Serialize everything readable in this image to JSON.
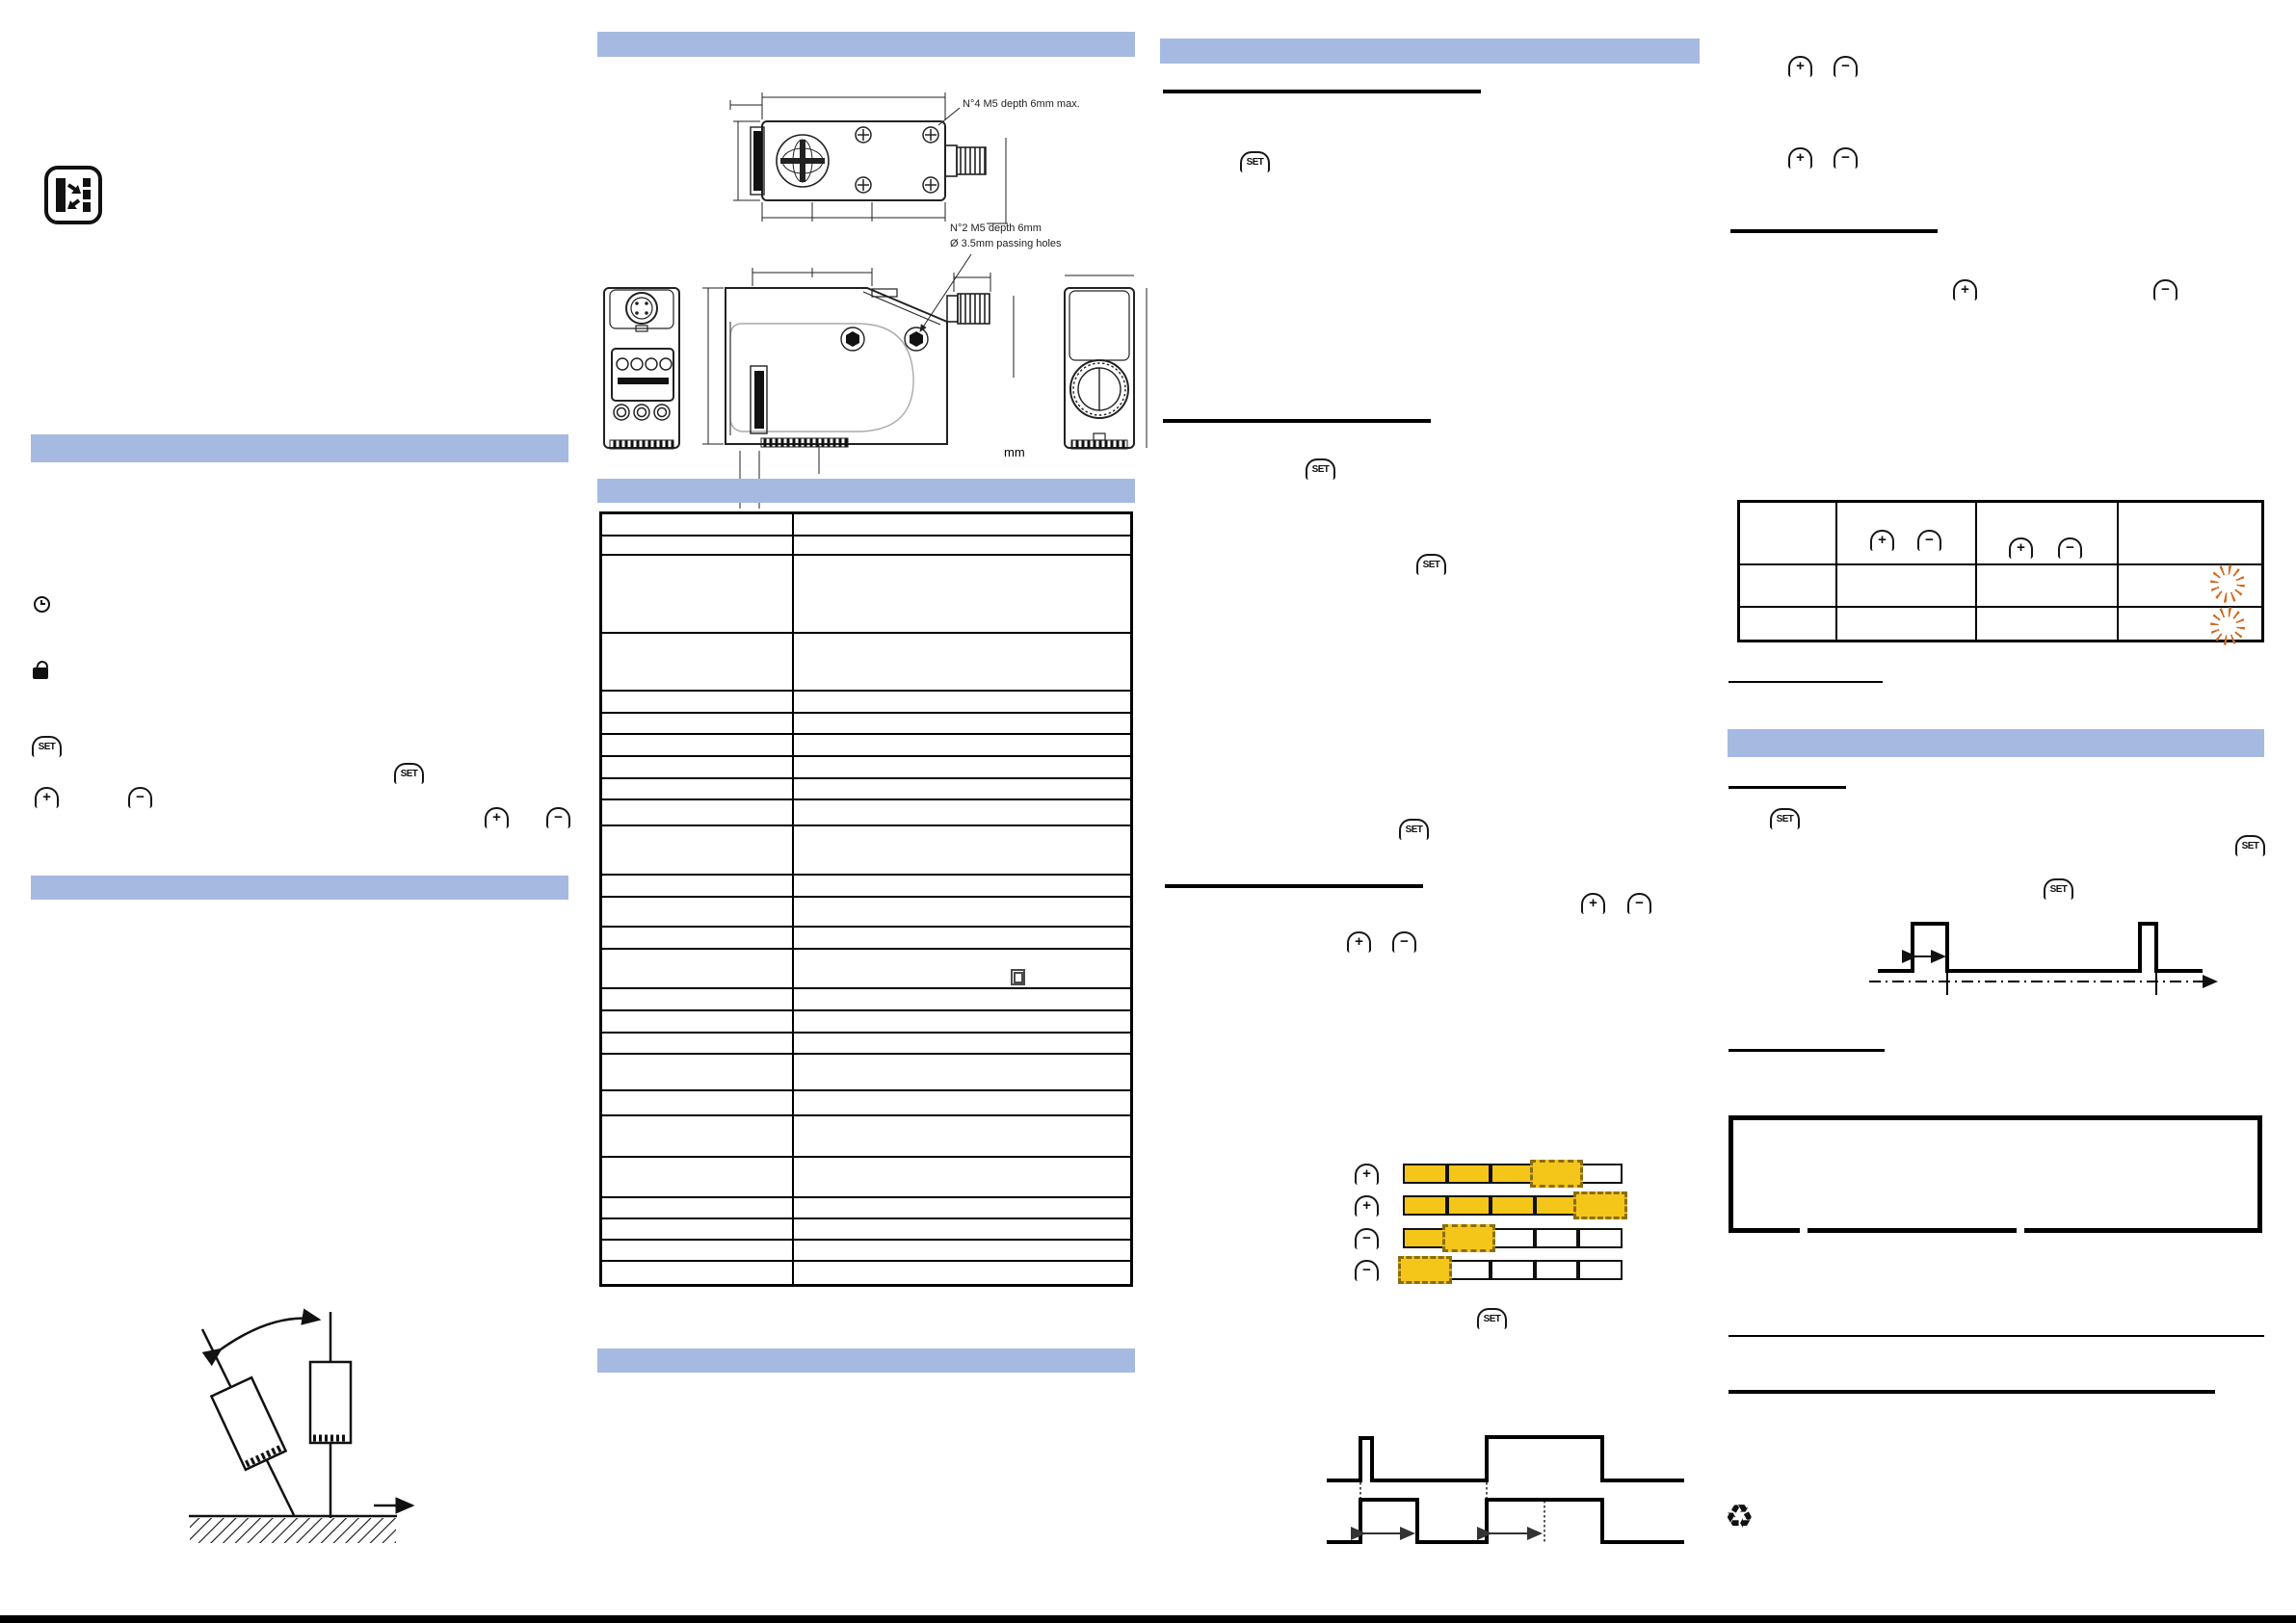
{
  "doc": {
    "colors": {
      "section_bar": "#a5b9e1",
      "led_on_yellow": "#f5c61a",
      "led_blink_dash": "#8a6d12",
      "blink_star_orange": "#d2691e",
      "line_black": "#000000"
    },
    "keys": {
      "set": "SET",
      "plus": "+",
      "minus": "−"
    },
    "glyphs": {
      "recycle": "♻"
    },
    "drawing_labels": {
      "top_note": "N°4 M5 depth 6mm max.",
      "side_note_1": "N°2 M5 depth 6mm",
      "side_note_2": "Ø 3.5mm passing holes",
      "units": "mm"
    },
    "icons": {
      "logo": "retroreflective-beam-icon",
      "clock": "response-time-icon",
      "lock": "keylock-icon",
      "class2": "double-insulation-icon",
      "blink": "blinking-led-icon",
      "recycle": "recycle-icon"
    },
    "led_figure": {
      "rows": [
        {
          "button": "plus",
          "segments": [
            "on",
            "on",
            "on",
            "blink",
            "off"
          ]
        },
        {
          "button": "plus",
          "segments": [
            "on",
            "on",
            "on",
            "on",
            "blink"
          ]
        },
        {
          "button": "minus",
          "segments": [
            "on",
            "blink",
            "off",
            "off",
            "off"
          ]
        },
        {
          "button": "minus",
          "segments": [
            "blink",
            "off",
            "off",
            "off",
            "off"
          ]
        }
      ]
    },
    "feedback_table": {
      "rows": 3,
      "cols": 4,
      "header_col2_keys": [
        "plus",
        "minus"
      ],
      "header_col3_keys": [
        "plus",
        "minus"
      ],
      "blink_cells": [
        [
          2,
          4
        ],
        [
          3,
          4
        ]
      ]
    },
    "spec_table": {
      "rows": 26,
      "columns": 2,
      "content": "empty grid"
    }
  }
}
